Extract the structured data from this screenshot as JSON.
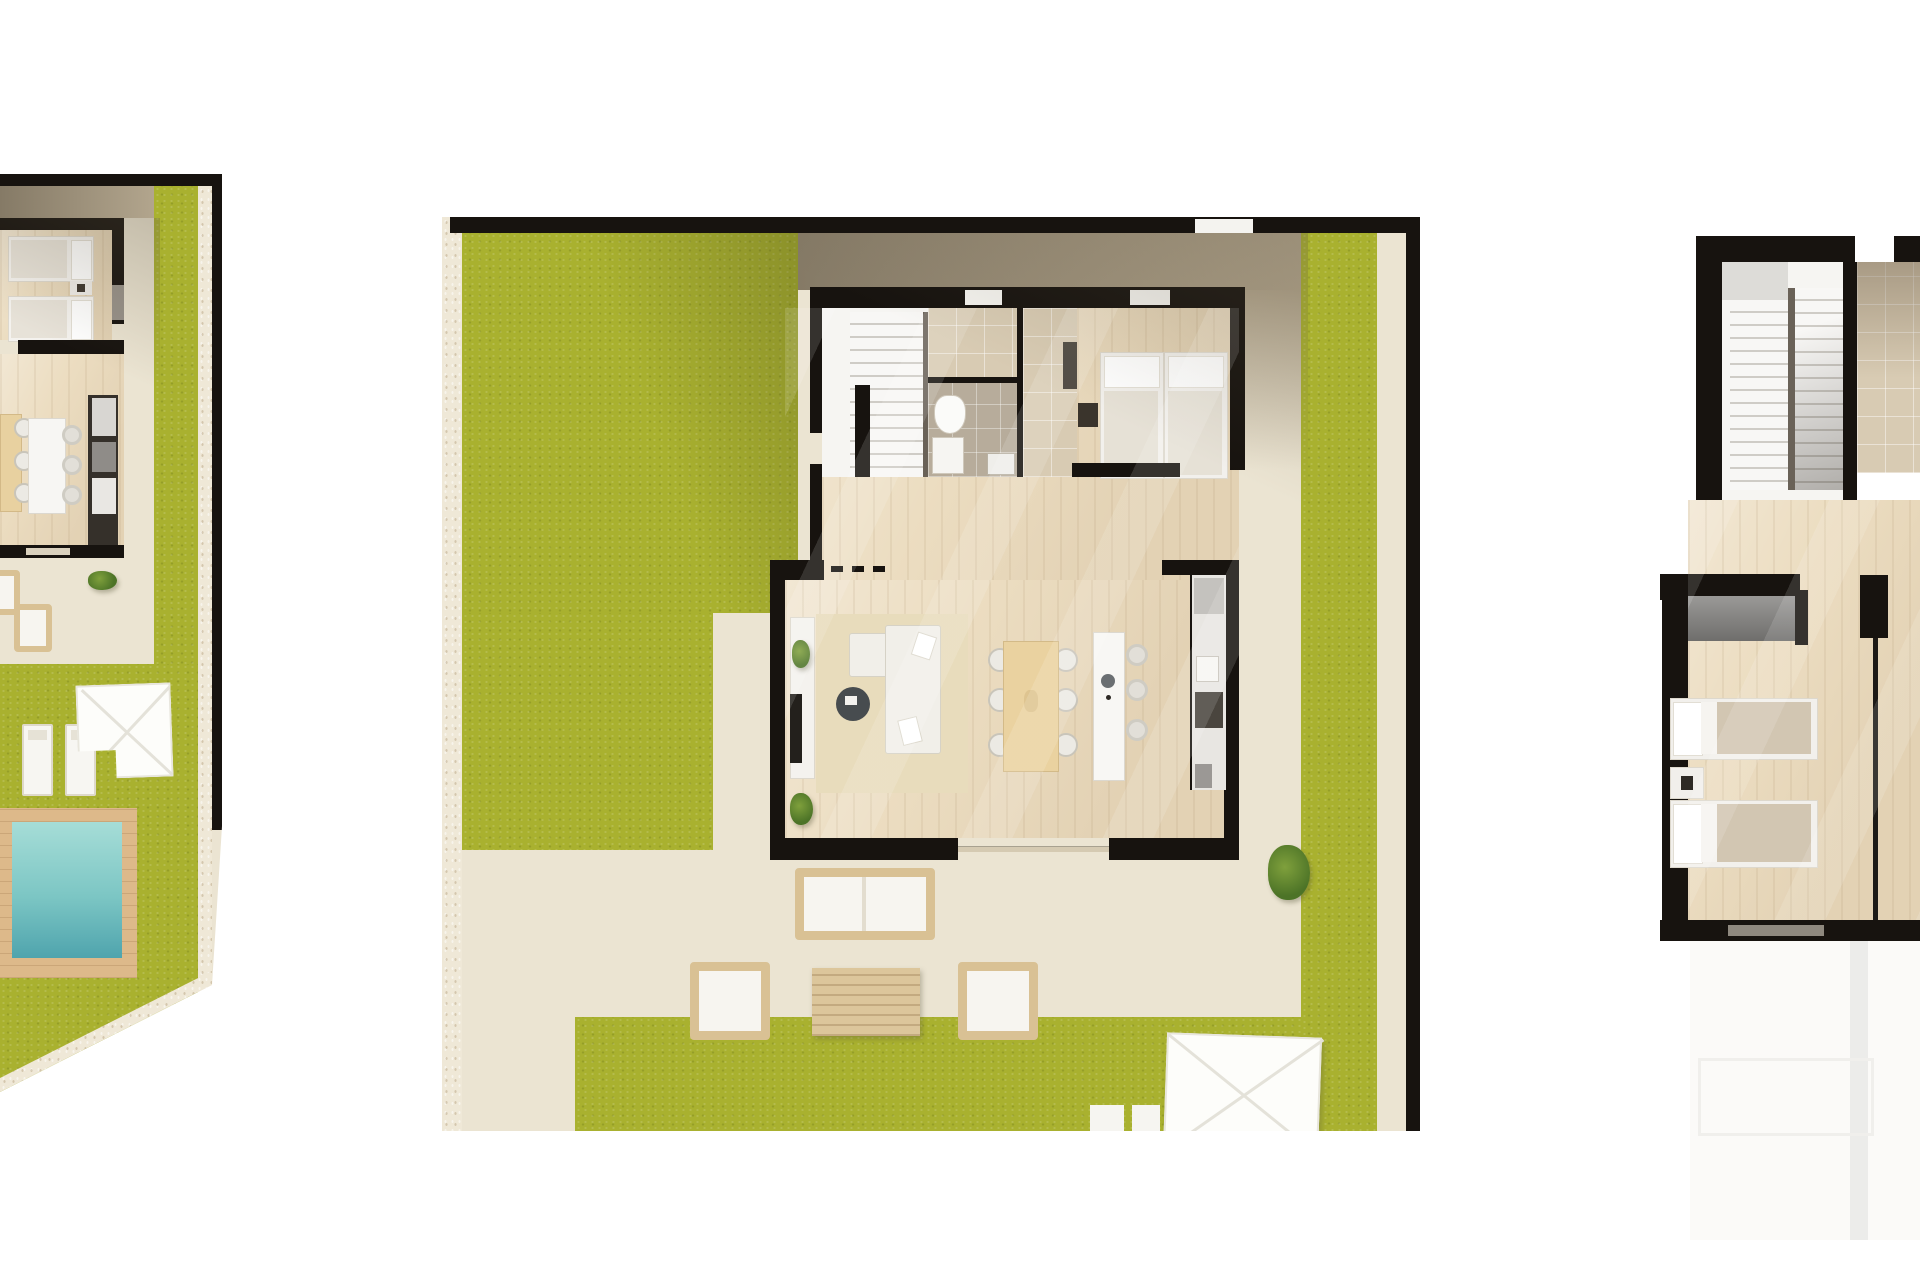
{
  "scene": {
    "kind": "architectural-floor-plan-render",
    "background": "white",
    "panel_count": 3
  },
  "palette": {
    "paper": "#ffffff",
    "wall": "#17130f",
    "grass": "#a9b12f",
    "patio": "#ebe4d2",
    "stone": "#efe8d7",
    "terrace-dark": "#857a66",
    "terrace-light": "#b2a58d",
    "wood": "#ecddc1",
    "tile-gray": "#b7ac9b",
    "tile-beige": "#d8cbb3",
    "sofa": "#f1efe9",
    "rattan": "#d9c194",
    "deck": "#ddb98a",
    "pool-water": "#7cc6c4",
    "counter-dark": "#35302a",
    "blanket-tan": "#d2c6b2",
    "wardrobe-gray": "#8b8a88"
  },
  "panels": [
    {
      "id": "villa-plan-left-partial",
      "clipped_edge": "left",
      "rooms": [
        "bedroom-twin",
        "kitchen-dining"
      ],
      "outdoor": [
        "lawn",
        "patio",
        "sun-loungers",
        "parasol",
        "swimming-pool",
        "pool-deck"
      ],
      "furniture": [
        "twin-beds",
        "kitchen-island",
        "bar-stools",
        "dining-table",
        "kitchen-counter",
        "outdoor-armchair",
        "outdoor-lounger",
        "planter"
      ]
    },
    {
      "id": "villa-plan-ground-floor-main",
      "clipped_edge": "none",
      "rooms": [
        "stair-hall",
        "bathroom",
        "dressing-room",
        "bedroom-twin",
        "living-dining-kitchen"
      ],
      "outdoor": [
        "lawn",
        "patio",
        "terrace-band",
        "garden-path",
        "outdoor-lounge-set",
        "parasol",
        "planter"
      ],
      "furniture": [
        "staircase",
        "toilet",
        "shower-tray",
        "twin-beds",
        "nightstand",
        "l-shaped-sofa",
        "round-coffee-table",
        "tv-sideboard",
        "rug",
        "dining-table-six-chairs",
        "kitchen-island-sink",
        "bar-stools",
        "kitchen-counter-appliances",
        "outdoor-loveseat",
        "outdoor-armchairs",
        "slatted-coffee-table"
      ]
    },
    {
      "id": "villa-plan-upper-floor-partial",
      "clipped_edge": "right",
      "rooms": [
        "stair-landing",
        "tiled-hall",
        "bedroom-twin"
      ],
      "outdoor": [
        "roof-terrace-below"
      ],
      "furniture": [
        "double-flight-staircase",
        "wardrobe",
        "twin-beds",
        "nightstand",
        "open-door"
      ]
    }
  ]
}
